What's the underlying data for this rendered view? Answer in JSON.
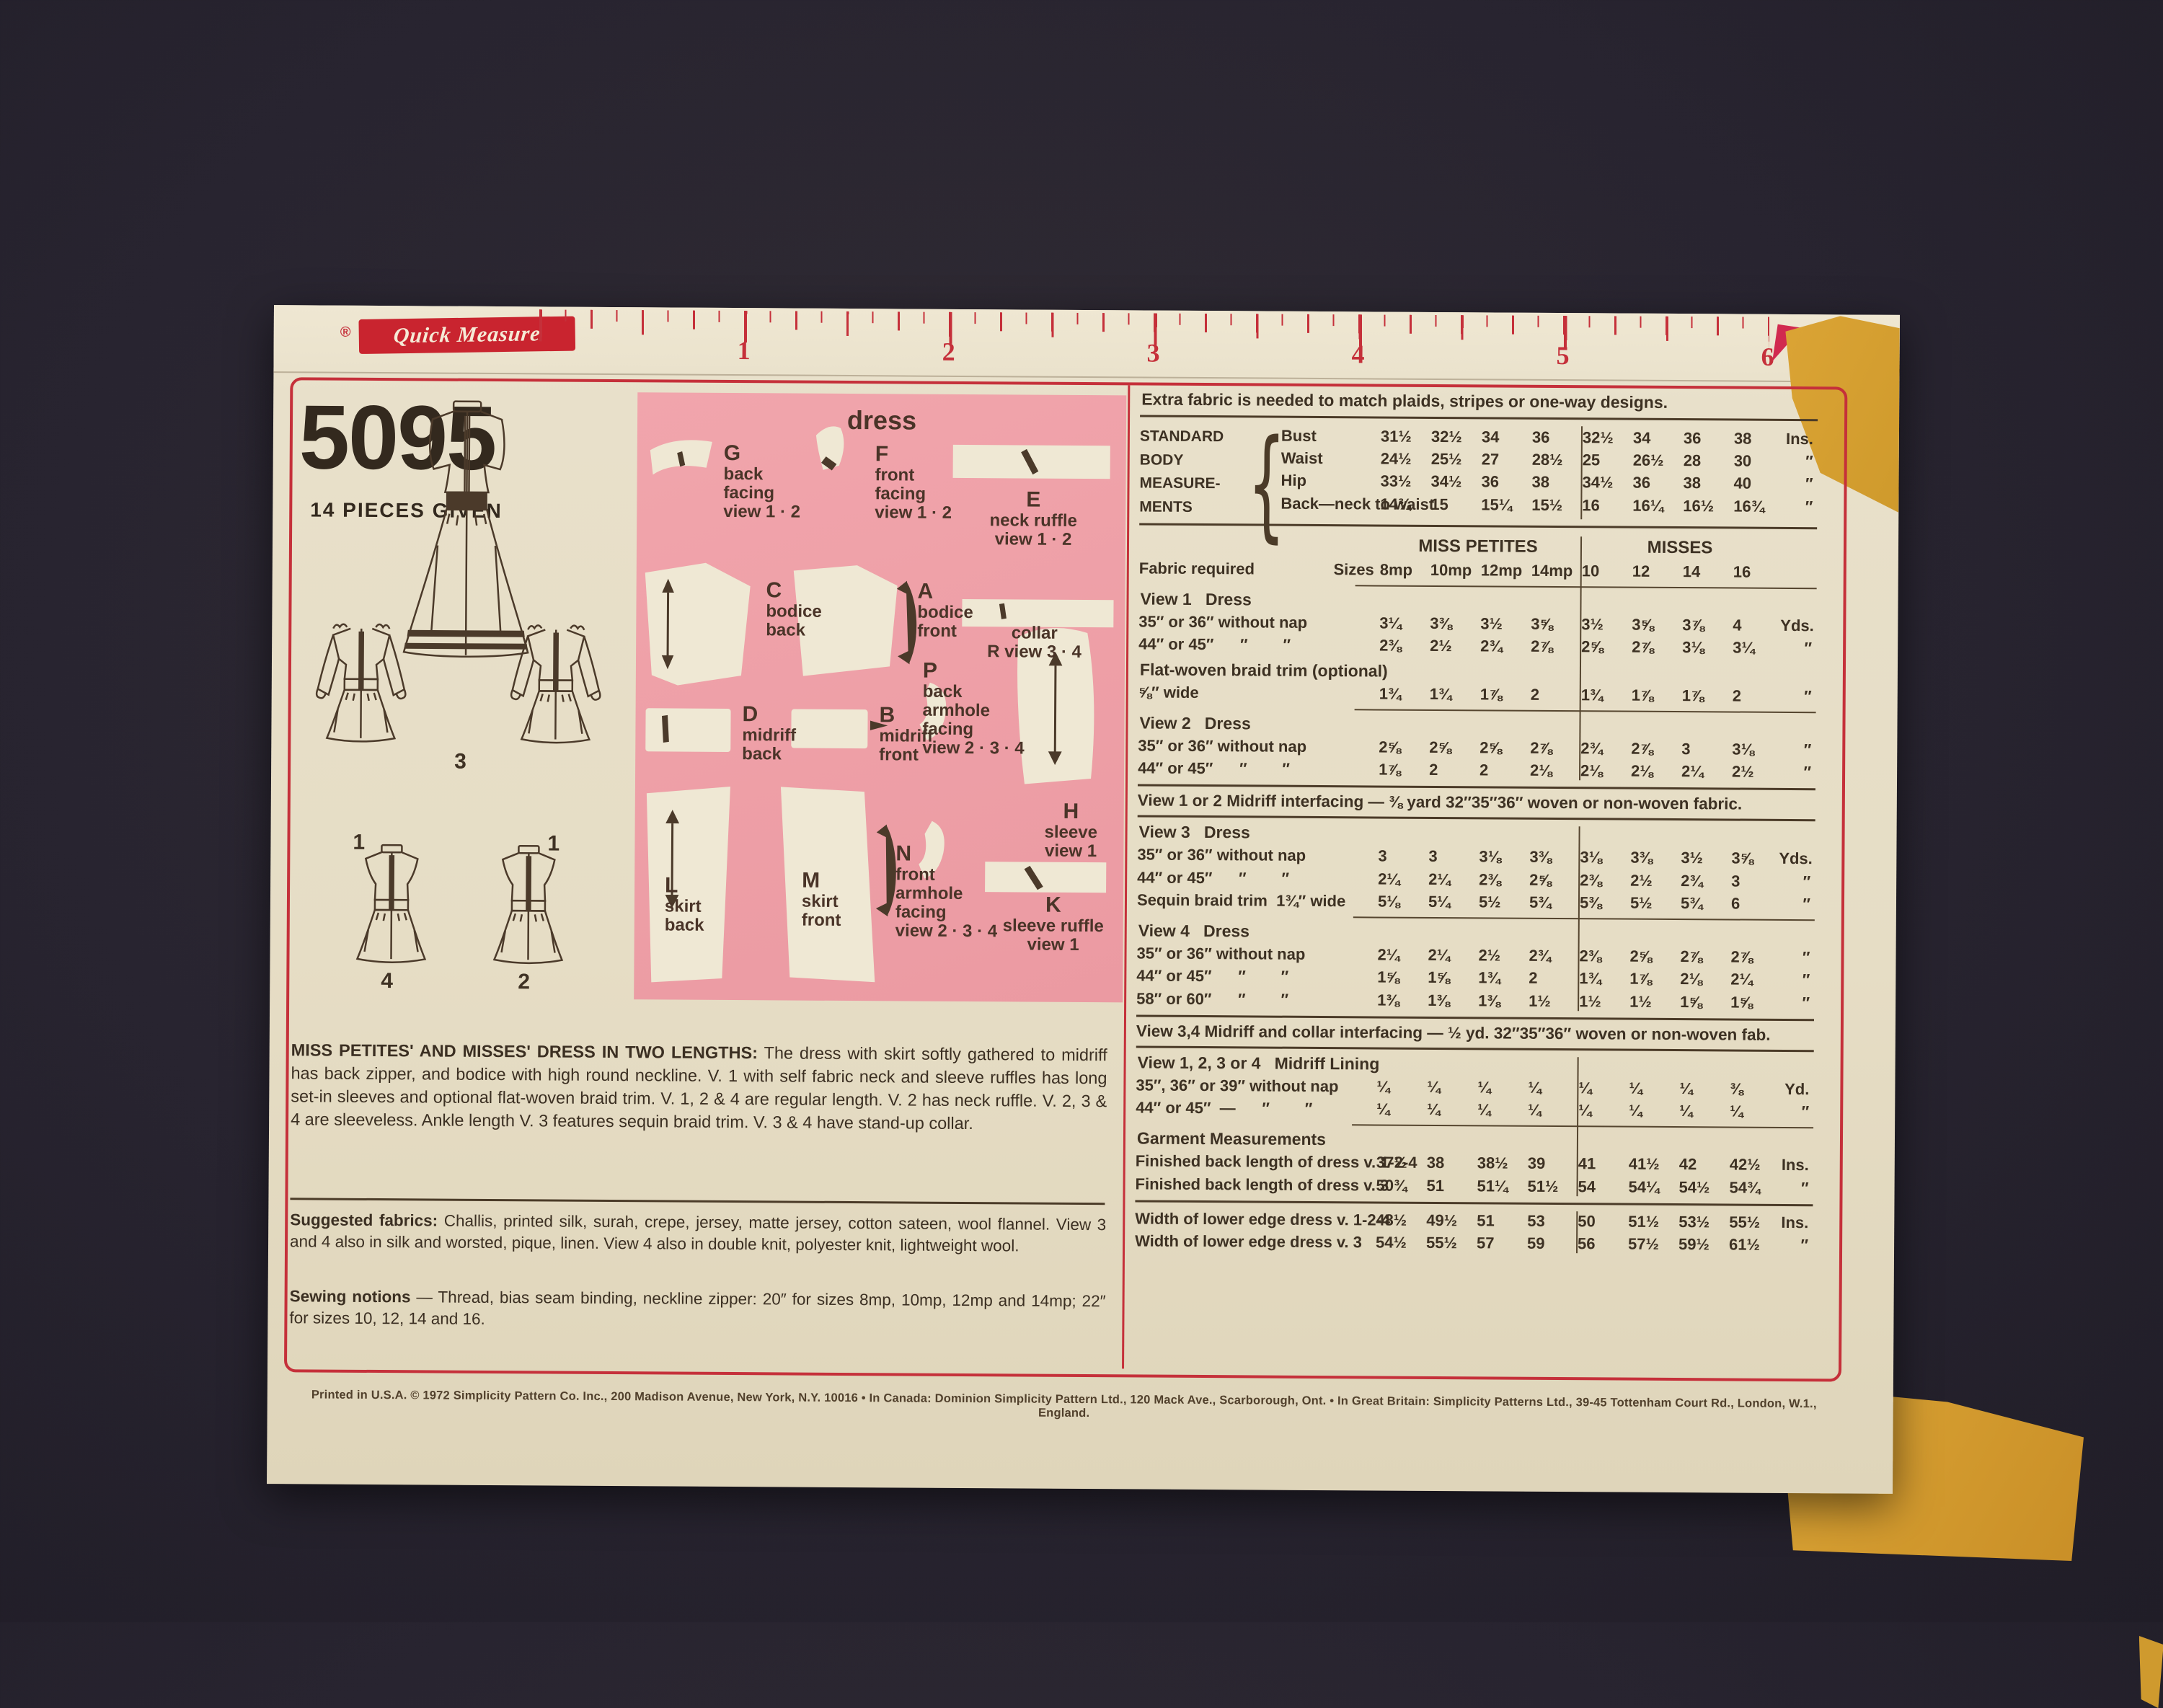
{
  "ruler": {
    "reg": "®",
    "brand": "Quick Measure",
    "numbers": [
      "1",
      "2",
      "3",
      "4",
      "5",
      "6"
    ]
  },
  "left": {
    "pattern_number": "5095",
    "pieces_given": "14 PIECES GIVEN",
    "view_labels": {
      "v3": "3",
      "v1a": "1",
      "v1b": "1",
      "v4": "4",
      "v2": "2"
    },
    "description_title": "MISS PETITES' AND MISSES' DRESS IN TWO LENGTHS:",
    "description_body": " The dress with skirt softly gathered to midriff has back zipper, and bodice with high round neckline. V. 1 with self fabric neck and sleeve ruffles has long set-in sleeves and optional flat-woven braid trim. V. 1, 2 & 4 are regular length. V. 2 has neck ruffle. V. 2, 3 & 4 are sleeveless. Ankle length V. 3 features sequin braid trim. V. 3 & 4 have stand-up collar.",
    "suggested_label": "Suggested fabrics:",
    "suggested_body": " Challis, printed silk, surah, crepe, jersey, matte jersey, cotton sateen, wool flannel. View 3 and 4 also in silk and worsted, pique, linen. View 4 also in double knit, polyester knit, lightweight wool.",
    "notions_label": "Sewing notions",
    "notions_body": " — Thread, bias seam binding, neckline zipper: 20″ for sizes 8mp, 10mp, 12mp and 14mp; 22″ for sizes 10, 12, 14 and 16."
  },
  "pink": {
    "title": "dress",
    "pieces": {
      "g": {
        "letter": "G",
        "lines": [
          "back",
          "facing",
          "view 1 · 2"
        ]
      },
      "f": {
        "letter": "F",
        "lines": [
          "front",
          "facing",
          "view 1 · 2"
        ]
      },
      "e": {
        "letter": "E",
        "lines": [
          "neck  ruffle",
          "view 1 · 2"
        ]
      },
      "c": {
        "letter": "C",
        "lines": [
          "bodice",
          "back"
        ]
      },
      "a": {
        "letter": "A",
        "lines": [
          "bodice",
          "front"
        ]
      },
      "r": {
        "letter": "",
        "lines": [
          "collar",
          "R  view 3 · 4"
        ]
      },
      "d": {
        "letter": "D",
        "lines": [
          "midriff",
          "back"
        ]
      },
      "b": {
        "letter": "B",
        "lines": [
          "midriff",
          "front"
        ]
      },
      "p": {
        "letter": "P",
        "lines": [
          "back",
          "armhole",
          "facing",
          "view 2 · 3 · 4"
        ]
      },
      "h": {
        "letter": "H",
        "lines": [
          "sleeve",
          "view 1"
        ]
      },
      "l": {
        "letter": "L",
        "lines": [
          "skirt",
          "back"
        ]
      },
      "m": {
        "letter": "M",
        "lines": [
          "skirt",
          "front"
        ]
      },
      "n": {
        "letter": "N",
        "lines": [
          "front",
          "armhole",
          "facing",
          "view 2 · 3 · 4"
        ]
      },
      "k": {
        "letter": "K",
        "lines": [
          "sleeve  ruffle",
          "view 1"
        ]
      }
    }
  },
  "table": {
    "extra_note": "Extra fabric is needed to match plaids, stripes or one-way designs.",
    "meas": {
      "l1": "STANDARD",
      "l2": "BODY",
      "l3": "MEASURE-",
      "l4": "MENTS",
      "brace": "{",
      "bust": {
        "label": "Bust",
        "mp": [
          "31½",
          "32½",
          "34",
          "36"
        ],
        "m": [
          "32½",
          "34",
          "36",
          "38"
        ],
        "unit": "Ins."
      },
      "waist": {
        "label": "Waist",
        "mp": [
          "24½",
          "25½",
          "27",
          "28½"
        ],
        "m": [
          "25",
          "26½",
          "28",
          "30"
        ],
        "unit": "″"
      },
      "hip": {
        "label": "Hip",
        "mp": [
          "33½",
          "34½",
          "36",
          "38"
        ],
        "m": [
          "34½",
          "36",
          "38",
          "40"
        ],
        "unit": "″"
      },
      "back": {
        "label": "Back—neck to waist",
        "mp": [
          "14¾",
          "15",
          "15¼",
          "15½"
        ],
        "m": [
          "16",
          "16¼",
          "16½",
          "16¾"
        ],
        "unit": "″"
      }
    },
    "groups": {
      "mp": "MISS PETITES",
      "m": "MISSES"
    },
    "sizes": {
      "label": "Fabric required",
      "word": "Sizes",
      "c1": "8mp",
      "c2": "10mp",
      "c3": "12mp",
      "c4": "14mp",
      "c5": "10",
      "c6": "12",
      "c7": "14",
      "c8": "16"
    },
    "v1": {
      "head": "View 1   Dress",
      "r1": {
        "label": "35″ or 36″ without nap",
        "mp": [
          "3¼",
          "3⅜",
          "3½",
          "3⅝"
        ],
        "m": [
          "3½",
          "3⅝",
          "3⅞",
          "4"
        ],
        "unit": "Yds."
      },
      "r2": {
        "label": "44″ or 45″      ″        ″",
        "mp": [
          "2⅜",
          "2½",
          "2¾",
          "2⅞"
        ],
        "m": [
          "2⅝",
          "2⅞",
          "3⅛",
          "3¼"
        ],
        "unit": "″"
      }
    },
    "braid": {
      "head": "Flat-woven braid trim (optional)",
      "r1": {
        "label": "⅝″ wide",
        "mp": [
          "1¾",
          "1¾",
          "1⅞",
          "2"
        ],
        "m": [
          "1¾",
          "1⅞",
          "1⅞",
          "2"
        ],
        "unit": "″"
      }
    },
    "v2": {
      "head": "View 2   Dress",
      "r1": {
        "label": "35″ or 36″ without nap",
        "mp": [
          "2⅝",
          "2⅝",
          "2⅝",
          "2⅞"
        ],
        "m": [
          "2¾",
          "2⅞",
          "3",
          "3⅛"
        ],
        "unit": "″"
      },
      "r2": {
        "label": "44″ or 45″      ″        ″",
        "mp": [
          "1⅞",
          "2",
          "2",
          "2⅛"
        ],
        "m": [
          "2⅛",
          "2⅛",
          "2¼",
          "2½"
        ],
        "unit": "″"
      }
    },
    "note12": "View 1 or 2 Midriff interfacing — ⅜ yard 32″35″36″ woven or non-woven fabric.",
    "v3": {
      "head": "View 3   Dress",
      "r1": {
        "label": "35″ or 36″ without nap",
        "mp": [
          "3",
          "3",
          "3⅛",
          "3⅜"
        ],
        "m": [
          "3⅛",
          "3⅜",
          "3½",
          "3⅝"
        ],
        "unit": "Yds."
      },
      "r2": {
        "label": "44″ or 45″      ″        ″",
        "mp": [
          "2¼",
          "2¼",
          "2⅜",
          "2⅝"
        ],
        "m": [
          "2⅜",
          "2½",
          "2¾",
          "3"
        ],
        "unit": "″"
      },
      "sequin": {
        "label": "Sequin braid trim  1¾″ wide",
        "mp": [
          "5⅛",
          "5¼",
          "5½",
          "5¾"
        ],
        "m": [
          "5⅜",
          "5½",
          "5¾",
          "6"
        ],
        "unit": "″"
      }
    },
    "v4": {
      "head": "View 4   Dress",
      "r1": {
        "label": "35″ or 36″ without nap",
        "mp": [
          "2¼",
          "2¼",
          "2½",
          "2¾"
        ],
        "m": [
          "2⅜",
          "2⅝",
          "2⅞",
          "2⅞"
        ],
        "unit": "″"
      },
      "r2": {
        "label": "44″ or 45″      ″        ″",
        "mp": [
          "1⅝",
          "1⅝",
          "1¾",
          "2"
        ],
        "m": [
          "1¾",
          "1⅞",
          "2⅛",
          "2¼"
        ],
        "unit": "″"
      },
      "r3": {
        "label": "58″ or 60″      ″        ″",
        "mp": [
          "1⅜",
          "1⅜",
          "1⅜",
          "1½"
        ],
        "m": [
          "1½",
          "1½",
          "1⅝",
          "1⅝"
        ],
        "unit": "″"
      }
    },
    "note34": "View 3,4 Midriff and collar interfacing — ½ yd.  32″35″36″  woven or non-woven fab.",
    "lining": {
      "head": "View 1, 2, 3 or 4   Midriff Lining",
      "r1": {
        "label": "35″, 36″ or 39″ without nap",
        "mp": [
          "¼",
          "¼",
          "¼",
          "¼"
        ],
        "m": [
          "¼",
          "¼",
          "¼",
          "⅜"
        ],
        "unit": "Yd."
      },
      "r2": {
        "label": "44″ or 45″  —      ″        ″",
        "mp": [
          "¼",
          "¼",
          "¼",
          "¼"
        ],
        "m": [
          "¼",
          "¼",
          "¼",
          "¼"
        ],
        "unit": "″"
      }
    },
    "garment": {
      "head": "Garment Measurements",
      "r1": {
        "label": "Finished back length of dress v. 1-2-4",
        "mp": [
          "37½",
          "38",
          "38½",
          "39"
        ],
        "m": [
          "41",
          "41½",
          "42",
          "42½"
        ],
        "unit": "Ins."
      },
      "r2": {
        "label": "Finished back length of dress v. 3",
        "mp": [
          "50¾",
          "51",
          "51¼",
          "51½"
        ],
        "m": [
          "54",
          "54¼",
          "54½",
          "54¾"
        ],
        "unit": "″"
      }
    },
    "width": {
      "r1": {
        "label": "Width of lower edge dress v. 1-2-4",
        "mp": [
          "48½",
          "49½",
          "51",
          "53"
        ],
        "m": [
          "50",
          "51½",
          "53½",
          "55½"
        ],
        "unit": "Ins."
      },
      "r2": {
        "label": "Width of lower edge dress v. 3",
        "mp": [
          "54½",
          "55½",
          "57",
          "59"
        ],
        "m": [
          "56",
          "57½",
          "59½",
          "61½"
        ],
        "unit": "″"
      }
    }
  },
  "footer": {
    "fine_print": "Printed in U.S.A.   © 1972 Simplicity Pattern Co. Inc., 200 Madison Avenue, New York, N.Y. 10016 • In Canada: Dominion Simplicity Pattern Ltd., 120 Mack Ave., Scarborough, Ont. • In Great Britain: Simplicity Patterns Ltd., 39-45 Tottenham Court Rd., London, W.1., England."
  }
}
